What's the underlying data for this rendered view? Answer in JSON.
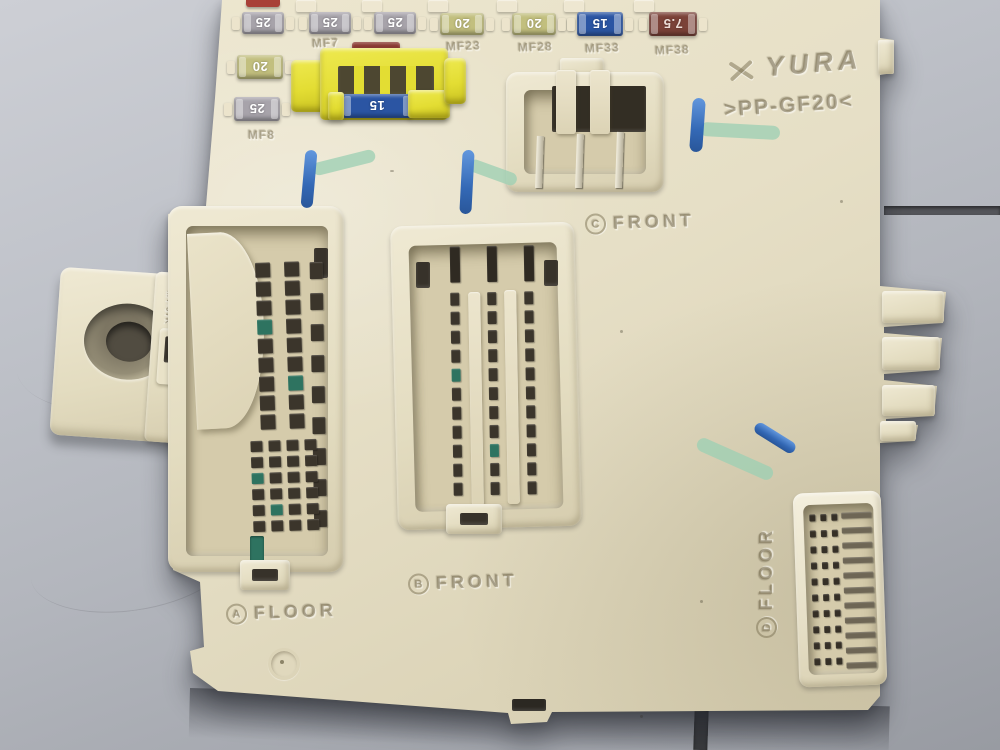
{
  "fusebox": {
    "brand": "YURA",
    "material_marking": ">PP-GF20<",
    "bracket": {
      "side_text": "LHD",
      "small_text": "MT-97K"
    },
    "connectors": {
      "a": {
        "letter": "A",
        "label": "FLOOR"
      },
      "b": {
        "letter": "B",
        "label": "FRONT"
      },
      "c": {
        "letter": "C",
        "label": "FRONT"
      },
      "d": {
        "letter": "D",
        "label": "FLOOR"
      }
    },
    "fuse_slots": {
      "mf7": "MF7",
      "mf8": "MF8",
      "mf23": "MF23",
      "mf28": "MF28",
      "mf33": "MF33",
      "mf38": "MF38"
    },
    "fuses": {
      "top_row": [
        {
          "value": "25",
          "color": "#a7a3aa",
          "text_color": "#ffffff"
        },
        {
          "value": "25",
          "color": "#a7a3aa",
          "text_color": "#ffffff"
        },
        {
          "value": "25",
          "color": "#a7a3aa",
          "text_color": "#ffffff"
        },
        {
          "value": "20",
          "color": "#c2bf7e",
          "text_color": "#ffffff"
        },
        {
          "value": "20",
          "color": "#c2bf7e",
          "text_color": "#ffffff"
        },
        {
          "value": "15",
          "color": "#2b55a3",
          "text_color": "#ffffff"
        },
        {
          "value": "7.5",
          "color": "#7b4238",
          "text_color": "#ecdcd6"
        }
      ],
      "left_column": [
        {
          "value": "20",
          "color": "#c2bf7e",
          "text_color": "#ffffff"
        },
        {
          "value": "25",
          "color": "#a7a3aa",
          "text_color": "#ffffff"
        }
      ],
      "relay_socket_fuse": {
        "value": "15",
        "color": "#2b55a3",
        "text_color": "#ffffff"
      },
      "partial_top_fuse_color": "#a84038",
      "hidden_fuse_color": "#8a3a33"
    },
    "marker_annotations": {
      "blue": "#2e6fca",
      "green": "#a5d4ba",
      "count": 4
    }
  }
}
